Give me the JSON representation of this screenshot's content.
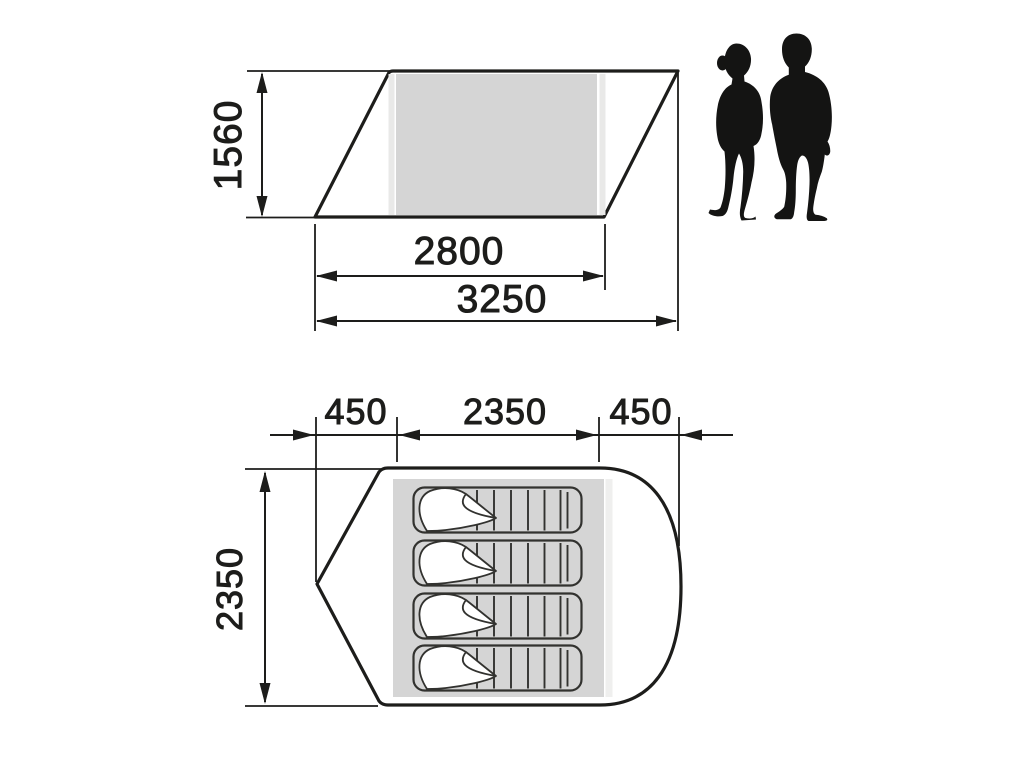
{
  "colors": {
    "line": "#1d1d1b",
    "panel_gray": "#d5d5d5",
    "panel_light": "#e9e9e8",
    "plan_strip": "#efefee",
    "bag_stroke": "#32322f",
    "silhouette": "#141413"
  },
  "side_view": {
    "dim_height": "1560",
    "dim_inner_width": "2800",
    "dim_total_width": "3250"
  },
  "floor_plan": {
    "dim_left_section": "450",
    "dim_inner_width": "2350",
    "dim_right_section": "450",
    "dim_depth": "2350"
  }
}
